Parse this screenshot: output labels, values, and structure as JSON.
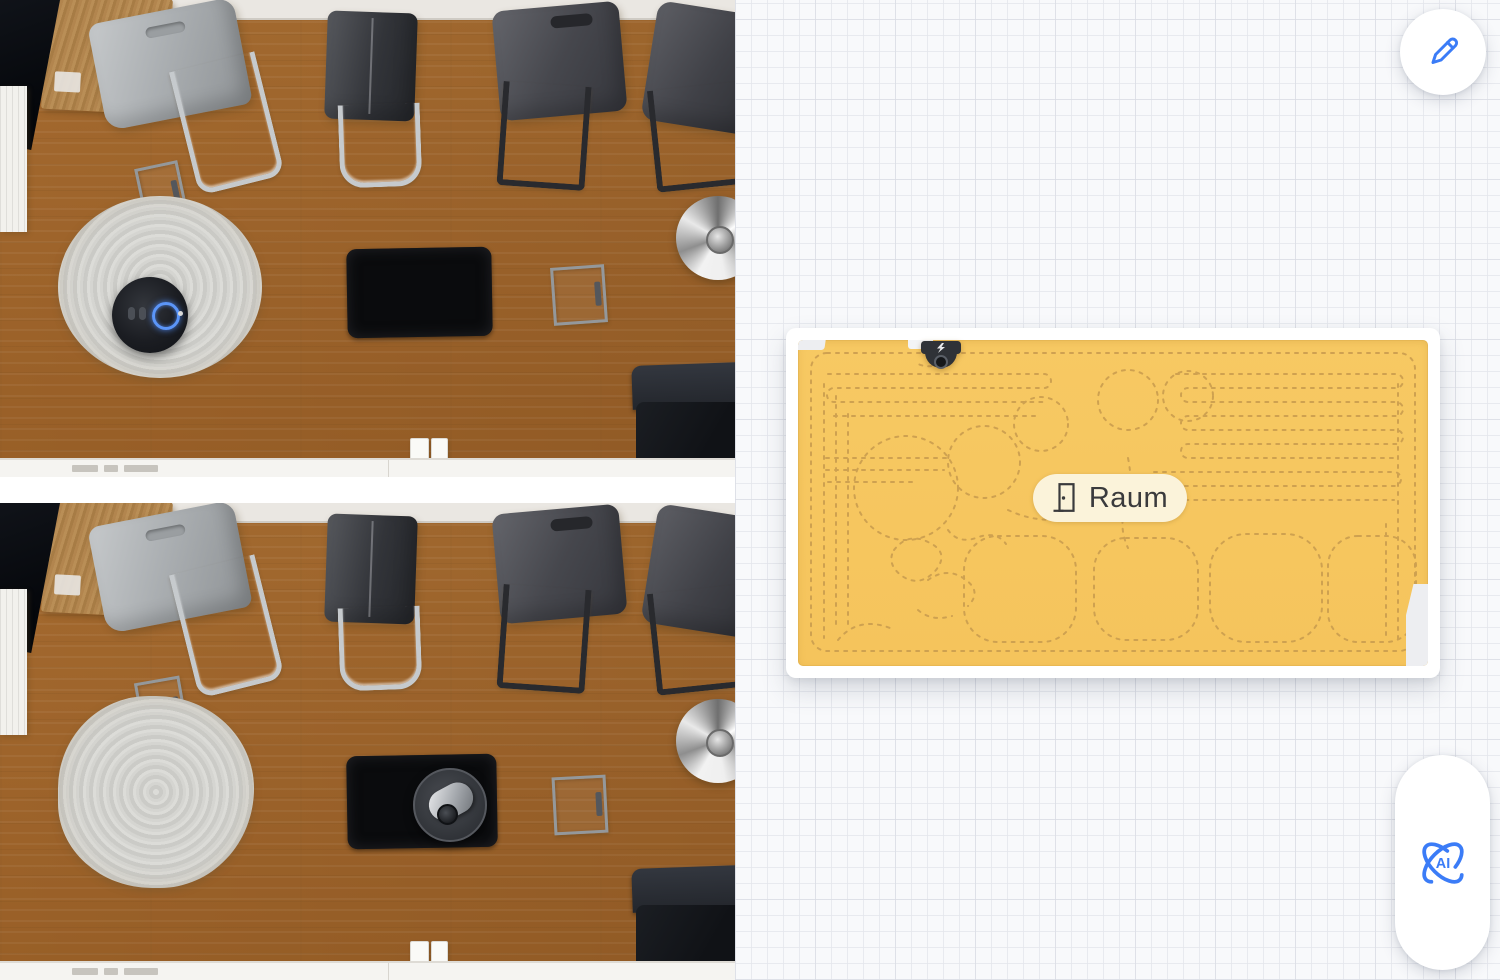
{
  "map_view": {
    "room_label": "Raum",
    "ai_badge": "AI"
  },
  "colors": {
    "accent_blue": "#3B7CF7",
    "map_fill": "#F6C65F",
    "map_path": "#C89B4E",
    "room_label_bg": "#FBF3DA",
    "room_label_text": "#3A3A3C",
    "panel_background": "#F8F9FB",
    "card_frame": "#FFFFFF"
  },
  "icons": {
    "edit": "pencil-icon",
    "ai": "ai-swirl-icon",
    "room": "door-icon",
    "dock": "charging-dock-icon",
    "robot_top_photo": "robot-vacuum-blue-ring",
    "robot_bottom_photo": "robot-vacuum-camera-module"
  }
}
